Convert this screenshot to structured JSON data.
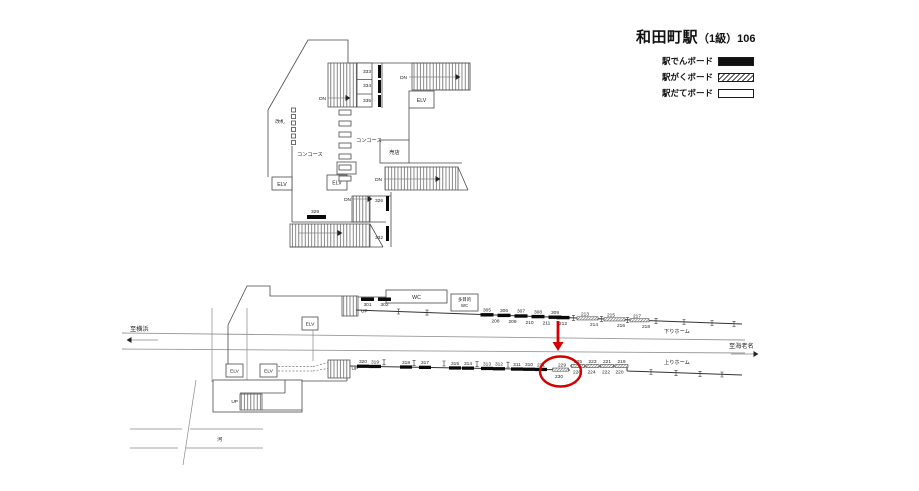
{
  "title": {
    "main": "和田町駅",
    "sub": "（1級）106"
  },
  "legend": {
    "items": [
      {
        "label": "駅でんボード",
        "style": "solid-black"
      },
      {
        "label": "駅がくボード",
        "style": "hatched"
      },
      {
        "label": "駅だてボード",
        "style": "outline-white"
      }
    ]
  },
  "colors": {
    "board_black": "#0a0a0a",
    "highlight_red": "#d40000"
  },
  "labels_common": {
    "dn": "DN",
    "up": "UP",
    "elv": "ELV"
  },
  "concourse": {
    "labels": {
      "kaisatsu": "改札",
      "concourse": "コンコース",
      "shop": "売店"
    },
    "boards": {
      "b333": "333",
      "b334": "334",
      "b335": "335",
      "b329": "329",
      "b326": "326",
      "b332": "332"
    }
  },
  "platform": {
    "labels": {
      "to_yokohama": "至横浜",
      "to_ebina": "至海老名",
      "down_home": "下りホーム",
      "up_home": "上りホーム",
      "river": "河",
      "wc": "WC",
      "multi_wc_1": "多目的",
      "multi_wc_2": "WC"
    },
    "down": {
      "n301": "301",
      "n302": "302",
      "n305": "305",
      "n306": "306",
      "n307": "307",
      "n308": "308",
      "n309": "309",
      "n208": "208",
      "n209": "209",
      "n210": "210",
      "n211": "211",
      "n212": "212",
      "n213": "213",
      "n214": "214",
      "n215": "215",
      "n216": "216",
      "n217": "217",
      "n218": "218"
    },
    "up": {
      "n320": "320",
      "n319": "319",
      "n318": "318",
      "n317": "317",
      "n315": "315",
      "n314": "314",
      "n313": "313",
      "n312": "312",
      "n311": "311",
      "n310": "310",
      "n231": "231",
      "n229": "229",
      "n230": "230",
      "n225": "225",
      "n223": "223",
      "n221": "221",
      "n219": "219",
      "n226": "226",
      "n224": "224",
      "n222": "222",
      "n220": "220"
    },
    "highlight": {
      "circled": [
        "229",
        "230"
      ]
    }
  }
}
